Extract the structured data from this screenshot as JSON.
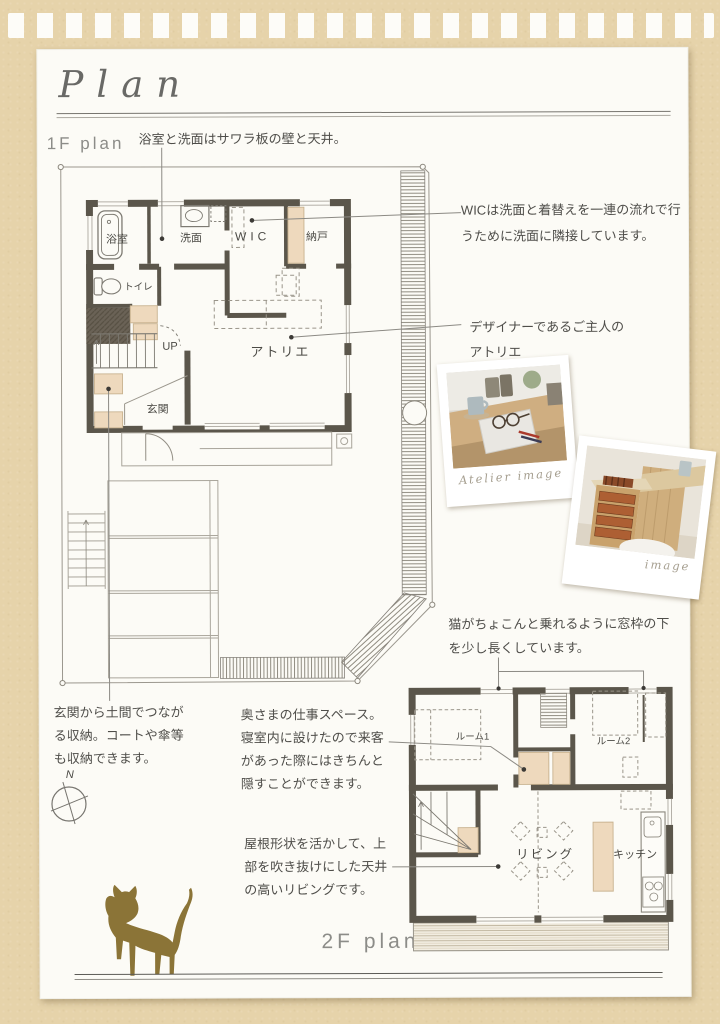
{
  "title": "Plan",
  "labels": {
    "plan1": "1F plan",
    "plan2": "2F plan"
  },
  "annotations": {
    "bath_walls": "浴室と洗面はサワラ板の壁と天井。",
    "wic": "WICは洗面と着替えを一連の流れで行うために洗面に隣接しています。",
    "atelier": "デザイナーであるご主人のアトリエ",
    "cat_window": "猫がちょこんと乗れるように窓枠の下を少し長くしています。",
    "doma_storage": "玄関から土間でつながる収納。コートや傘等も収納できます。",
    "workspace": "奥さまの仕事スペース。寝室内に設けたので来客があった際にはきちんと隠すことができます。",
    "living_ceiling": "屋根形状を活かして、上部を吹き抜けにした天井の高いリビングです。"
  },
  "floor1_rooms": {
    "bath": "浴室",
    "washroom": "洗面",
    "wic": "WIC",
    "closet": "納戸",
    "toilet": "トイレ",
    "stairs_up": "UP",
    "atelier": "アトリエ",
    "entrance": "玄関"
  },
  "floor2_rooms": {
    "room1": "ルーム1",
    "room2": "ルーム2",
    "living": "リビング",
    "kitchen": "キッチン"
  },
  "photos": {
    "atelier_caption": "Atelier image",
    "cabinet_caption": "image"
  },
  "compass": {
    "north": "N"
  },
  "colors": {
    "background": "#e6d3aa",
    "paper": "#fcfbf6",
    "wall": "#5b564b",
    "closet_beige": "#eed9bd",
    "cat_brown": "#8b7437",
    "note_text": "#4f4e4a"
  }
}
